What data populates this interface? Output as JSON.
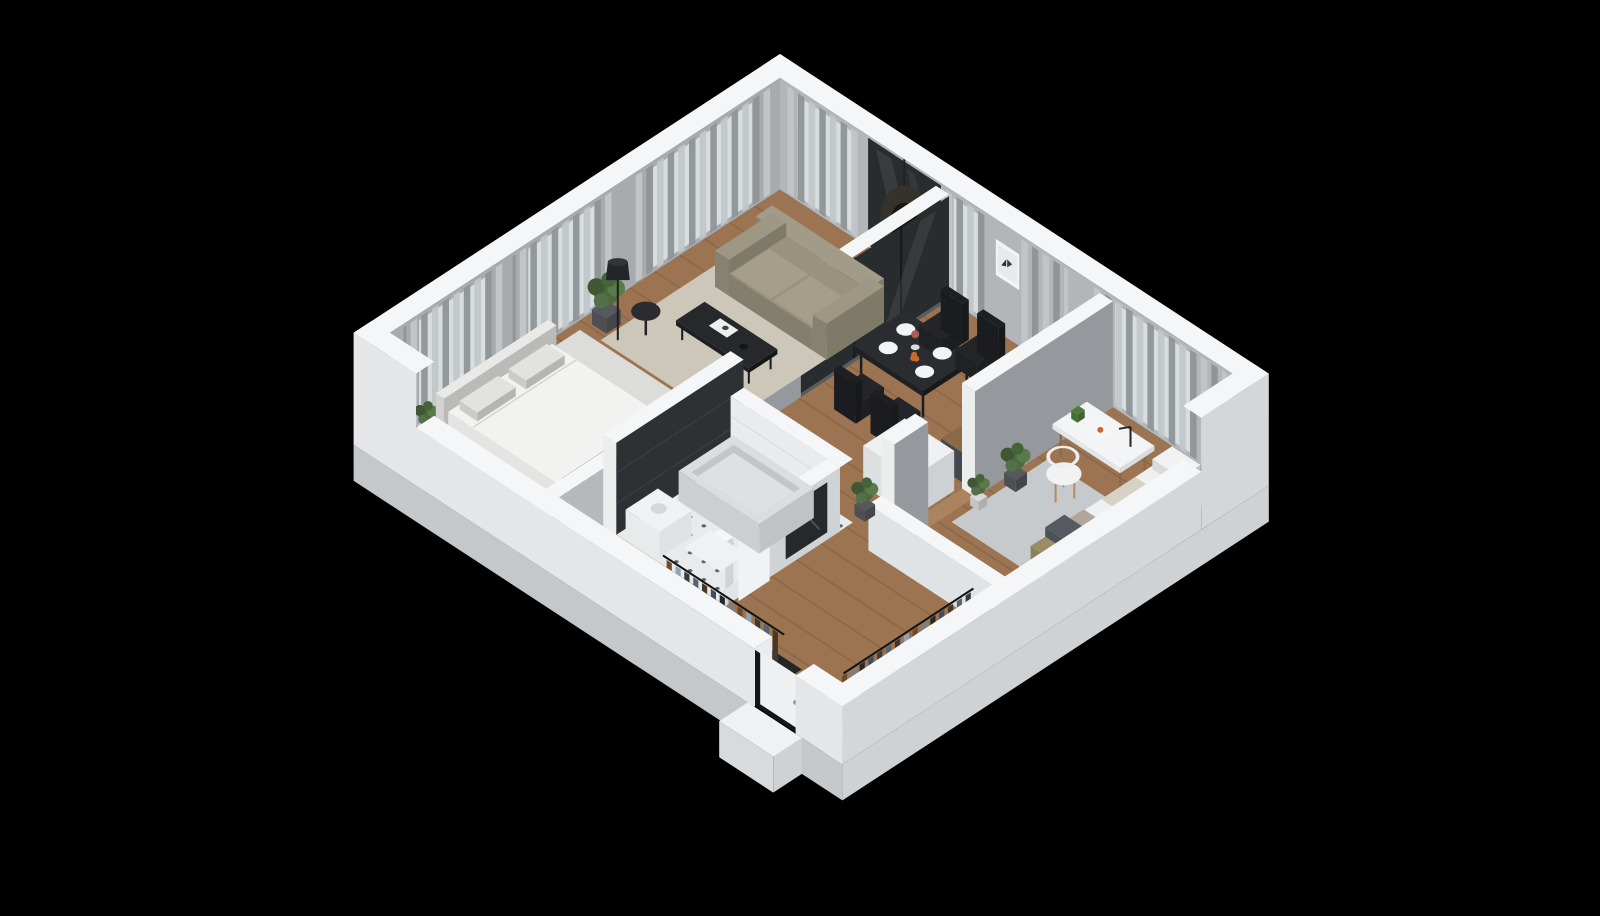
{
  "meta": {
    "title": "3D apartment floor plan — isometric cutaway render",
    "style": "dollhouse cutaway, black background, front walls cut low"
  },
  "icons": {
    "freezer_snowflake": "❄"
  },
  "palette": {
    "background": "#000000",
    "wall_top": "#f4f6f7",
    "wall_inner_left": "#a7abae",
    "wall_inner_top": "#b2b6b9",
    "wall_outer_front": "#e4e6e8",
    "wall_outer_right": "#d4d7da",
    "slab_side": "#c5c8cb",
    "partition_gray": "#95989c",
    "partition_dark": "#2e3134",
    "glass_dark": "#292c2f",
    "window_glow": "#d8dde0",
    "curtain": "#8f9396",
    "curtain_light": "#c2c6c9",
    "floor_wood": "#9c7451",
    "floor_wood_line": "#7a5a3d",
    "rug_living": "#cdc7b9",
    "rug_bedroom": "#dcdcda",
    "rug_kids": "#c7cacc",
    "tile_light": "#e8eaec",
    "tile_dot": "#3f4246",
    "white": "#f1f3f4",
    "sofa": "#98927f",
    "black_furniture": "#25272a",
    "bed_white": "#f2f2f0",
    "tub": "#ccd0d3",
    "counter_wood": "#8a6a48",
    "counter_front": "#45484c",
    "island_white": "#eef0f2",
    "snowflake_gray": "#9aa0a5",
    "plant_green": "#4d6a3f",
    "pot_dark": "#55585c",
    "mirror_dark": "#26292c",
    "door_white": "#eef0f2",
    "orange_fruit": "#c8692e",
    "pillow_dark": "#565b62",
    "pillow_olive": "#998d68",
    "pillow_blush": "#b3a49c",
    "wood_leg": "#8a6a47",
    "clothes_colors": [
      "#3e4d61",
      "#26292c",
      "#7b8086",
      "#6e4a2d",
      "#93a3b1",
      "#343a40",
      "#59636e",
      "#4a3826"
    ]
  },
  "rooms": [
    {
      "id": "living-dining",
      "label": "Living / Dining",
      "furniture": [
        "3-seat sofa",
        "coffee table",
        "round side table",
        "floor lamp",
        "beige rug",
        "dining table with 4 chairs",
        "table setting with plates, vase and fruit bowl",
        "hanging egg chair at balcony glass",
        "framed butterfly artwork",
        "curtained windows"
      ]
    },
    {
      "id": "kitchen",
      "label": "Kitchen",
      "furniture": [
        "counter with sink and faucet",
        "two-burner cooktop",
        "bin and speaker on counter",
        "white freezer island marked with snowflake"
      ]
    },
    {
      "id": "bedroom",
      "label": "Bedroom",
      "furniture": [
        "double bed with white duvet",
        "open wardrobe with hanging clothes",
        "light rug",
        "potted plants",
        "glass partition to living room",
        "curtained windows"
      ]
    },
    {
      "id": "kids-room",
      "label": "Kids room / study",
      "furniture": [
        "white desk",
        "desk lamp",
        "toy dinosaur",
        "open book",
        "white round chair",
        "gray rug",
        "daybed with pillows",
        "potted plants",
        "curtained window"
      ]
    },
    {
      "id": "bathroom",
      "label": "Bathroom",
      "furniture": [
        "bathtub",
        "dark accent tile wall",
        "white tile walls",
        "ornamental black-and-white floor tiles",
        "vanity with sink",
        "bath mat",
        "mirror on hall side"
      ]
    },
    {
      "id": "hallway",
      "label": "Entry hall",
      "furniture": [
        "long open wardrobe with hanging clothes",
        "second open wardrobe with hanging clothes",
        "potted plant",
        "entry door with doorstep"
      ]
    }
  ]
}
